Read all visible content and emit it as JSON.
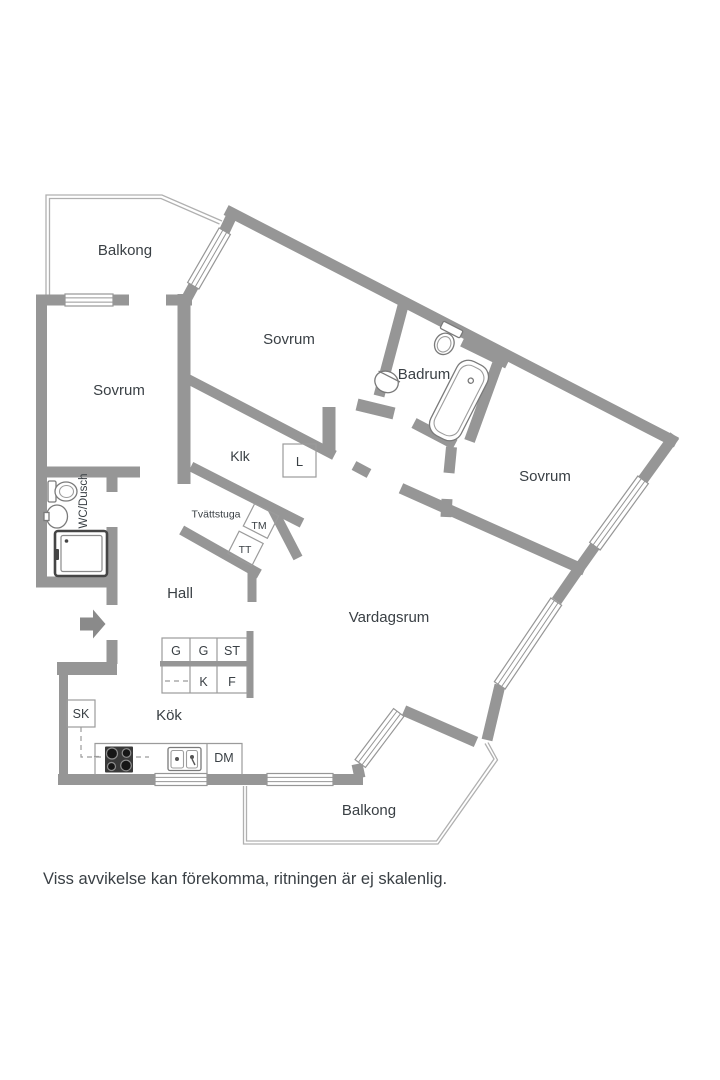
{
  "floorplan": {
    "labels": {
      "balcony_top": "Balkong",
      "bedroom_left": "Sovrum",
      "bedroom_mid": "Sovrum",
      "bedroom_right": "Sovrum",
      "bathroom": "Badrum",
      "closet": "Klk",
      "linen_closet": "L",
      "laundry": "Tvättstuga",
      "washer": "TM",
      "dryer": "TT",
      "wc_shower": "WC/Dusch",
      "hall": "Hall",
      "living_room": "Vardagsrum",
      "kitchen": "Kök",
      "cabinet_g1": "G",
      "cabinet_g2": "G",
      "cabinet_st": "ST",
      "cabinet_k": "K",
      "cabinet_f": "F",
      "cabinet_sk": "SK",
      "dishwasher": "DM",
      "balcony_bottom": "Balkong"
    },
    "footer": "Viss avvikelse kan förekomma, ritningen är ej skalenlig.",
    "colors": {
      "wall": "#969696",
      "thin": "#9b9b9b",
      "railing": "#b0b0b0",
      "fixture": "#7a7a7a",
      "dark": "#3d3d3d",
      "text": "#3a4045",
      "bg": "#ffffff"
    }
  }
}
